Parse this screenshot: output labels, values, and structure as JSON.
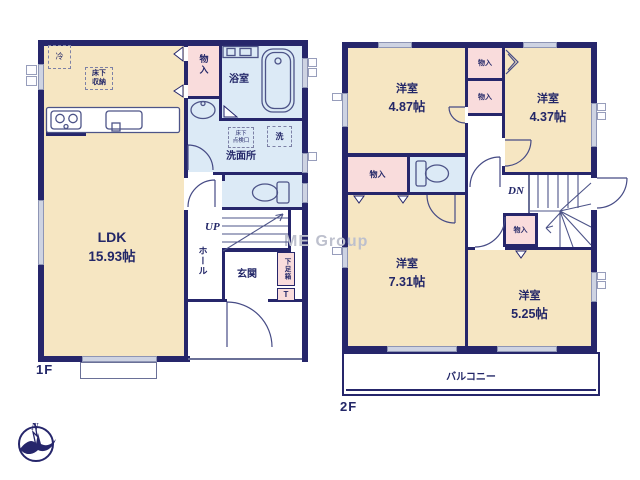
{
  "watermark": "ME Group",
  "compass": {
    "north": "N"
  },
  "palette": {
    "wall_navy": "#26266b",
    "room_tan": "#f6e6c2",
    "closet_pink": "#f9dcdc",
    "wet_blue": "#dceaf6",
    "text_navy": "#232768"
  },
  "floor1": {
    "label": "1F",
    "ldk_name": "LDK",
    "ldk_size": "15.93帖",
    "fridge": "冷",
    "underfloor_storage_l1": "床下",
    "underfloor_storage_l2": "収納",
    "closet": "物入",
    "bathroom": "浴室",
    "laundry": "洗",
    "underfloor_hatch_l1": "床下",
    "underfloor_hatch_l2": "点検口",
    "washroom": "洗面所",
    "stairs_up": "UP",
    "hall": "ホール",
    "entrance": "玄関",
    "shoe_box": "下足箱",
    "shoe_box_t": "T"
  },
  "floor2": {
    "label": "2F",
    "room_nw_name": "洋室",
    "room_nw_size": "4.87帖",
    "room_ne_name": "洋室",
    "room_ne_size": "4.37帖",
    "room_sw_name": "洋室",
    "room_sw_size": "7.31帖",
    "room_se_name": "洋室",
    "room_se_size": "5.25帖",
    "closet_a": "物入",
    "closet_b": "物入",
    "closet_c": "物入",
    "closet_d": "物入",
    "stairs_dn": "DN",
    "balcony": "バルコニー"
  }
}
